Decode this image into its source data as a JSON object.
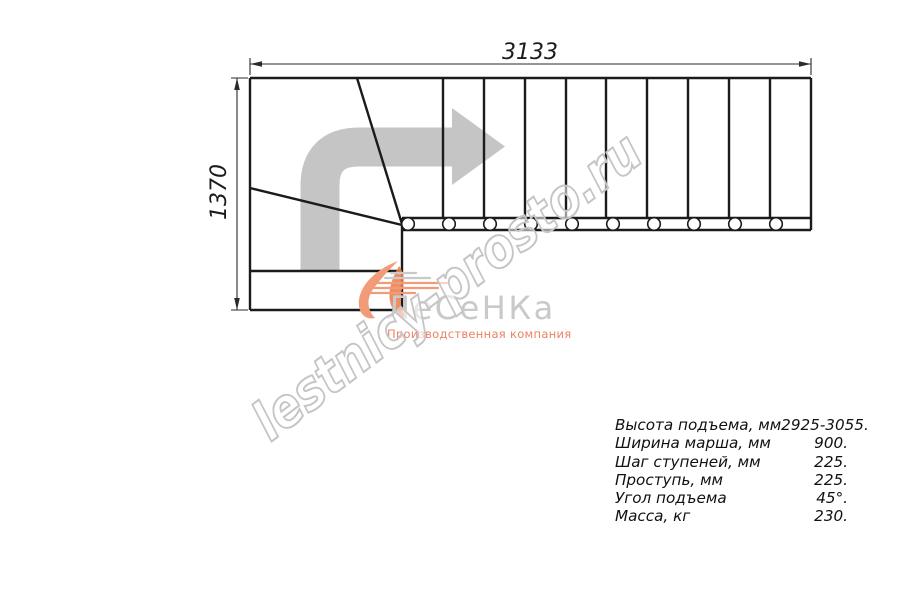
{
  "diagram": {
    "width_label": "3133",
    "height_label": "1370"
  },
  "logo": {
    "name": "ЛеСеНКа",
    "subtitle": "Производственная компания",
    "accent_color": "#f29b78",
    "subtitle_color": "#ec8164",
    "name_color": "#c9c9c9"
  },
  "watermark": {
    "text": "lestnicy-prosto.ru",
    "color": "#c5c5c5"
  },
  "arrow": {
    "color": "#c5c5c5"
  },
  "line_color": "#1b1b1b",
  "specs": {
    "rows": [
      {
        "label": "Высота подъема, мм",
        "value": "2925-3055."
      },
      {
        "label": "Ширина марша, мм",
        "value": "900."
      },
      {
        "label": "Шаг ступеней, мм",
        "value": "225."
      },
      {
        "label": "Проступь, мм",
        "value": "225."
      },
      {
        "label": "Угол подъема",
        "value": "45°."
      },
      {
        "label": "Масса, кг",
        "value": "230."
      }
    ]
  }
}
